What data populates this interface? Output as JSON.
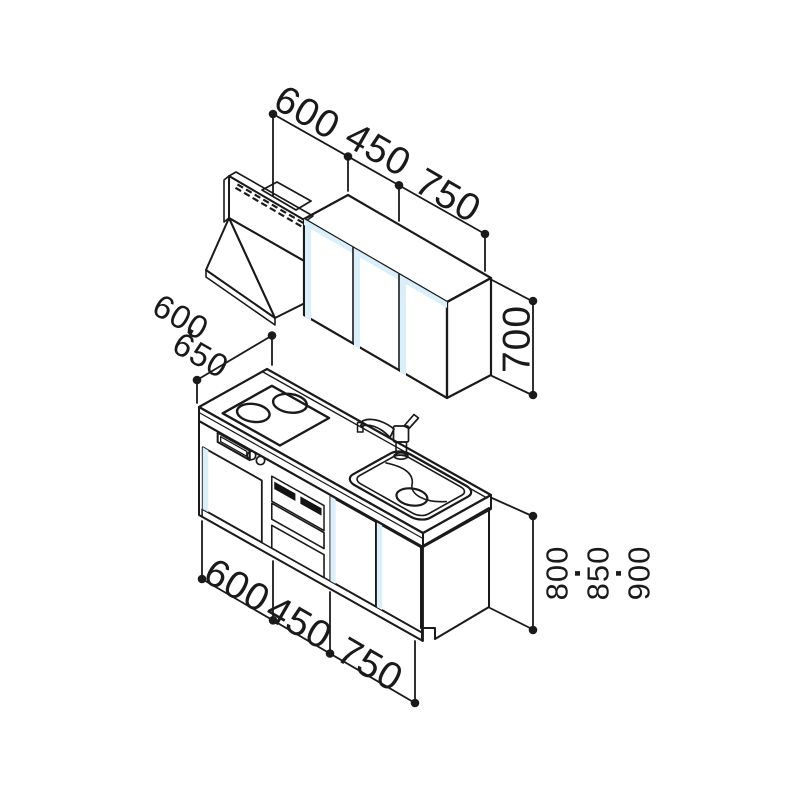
{
  "diagram": {
    "type": "kitchen-unit-isometric-dimension-diagram",
    "dimensions": {
      "top_widths_mm": [
        "600",
        "450",
        "750"
      ],
      "wall_cabinet_height_mm": "700",
      "counter_depths_mm": [
        "600",
        "650"
      ],
      "counter_heights_mm": [
        "800",
        "850",
        "900"
      ],
      "base_widths_mm": [
        "600",
        "450",
        "750"
      ],
      "separator": "·"
    },
    "components": {
      "range_hood": "range-hood",
      "wall_cabinets": "wall-cabinets-3-doors",
      "base_cabinet": "base-cabinet-with-cooktop-oven-sink"
    },
    "colors": {
      "line": "#1a1a1a",
      "cabinet_blue": "#b7e3f6",
      "cabinet_blue_highlight": "#d9f0fa",
      "counter_white": "#ffffff",
      "top_face_gray": "#d9dbdc",
      "side_face_gray": "#e9ebec",
      "hood_gray": "#c3c5c6",
      "hood_gray_light": "#cfd1d2",
      "hood_band_gray": "#cbcdce",
      "hood_gray_dark": "#9da0a2",
      "plinth_gray": "#9ba1a4",
      "oven_band_gray": "#8f9497"
    }
  }
}
